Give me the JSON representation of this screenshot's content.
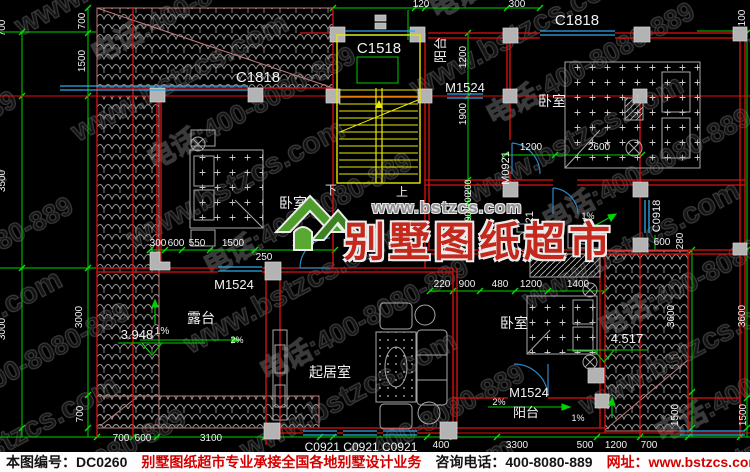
{
  "watermark": {
    "site": "www.bstzcs.com",
    "phone": "电话:400-8080-889"
  },
  "logo": {
    "site": "www.bstzcs.com",
    "name": "别墅图纸超市"
  },
  "footer": {
    "sheet_no": "本图编号：DC0260",
    "slogan": "别墅图纸超市专业承接全国各地别墅设计业务",
    "phone": "咨询电话：400-8080-889",
    "website": "网址：www.bstzcs.com"
  },
  "labels": [
    {
      "name": "dim-120-top",
      "text": "120",
      "x": 421,
      "y": 7,
      "size": 10
    },
    {
      "name": "dim-300-top",
      "text": "300",
      "x": 517,
      "y": 7,
      "size": 10
    },
    {
      "name": "dim-100-top-right",
      "text": "100",
      "x": 745,
      "y": 18,
      "size": 10,
      "rot": -90
    },
    {
      "name": "window-label-c1818-topright",
      "text": "C1818",
      "x": 577,
      "y": 25,
      "size": 15
    },
    {
      "name": "window-label-c1518",
      "text": "C1518",
      "x": 379,
      "y": 53,
      "size": 15
    },
    {
      "name": "room-label-balcony-top",
      "text": "阳台",
      "x": 445,
      "y": 50,
      "size": 13,
      "rot": -90
    },
    {
      "name": "dim-1200-corridor-top",
      "text": "1200",
      "x": 466,
      "y": 57,
      "size": 10,
      "rot": -90
    },
    {
      "name": "door-label-m1524-top",
      "text": "M1524",
      "x": 465,
      "y": 92,
      "size": 13
    },
    {
      "name": "window-label-c1818-topleft",
      "text": "C1818",
      "x": 258,
      "y": 82,
      "size": 15
    },
    {
      "name": "dim-700-left-outer",
      "text": "700",
      "x": 5,
      "y": 28,
      "size": 10,
      "rot": -90
    },
    {
      "name": "dim-700-left-inner",
      "text": "700",
      "x": 85,
      "y": 21,
      "size": 10,
      "rot": -90
    },
    {
      "name": "dim-1500-left-inner",
      "text": "1500",
      "x": 85,
      "y": 61,
      "size": 10,
      "rot": -90
    },
    {
      "name": "room-label-bedroom-topright",
      "text": "卧室",
      "x": 552,
      "y": 106,
      "size": 14
    },
    {
      "name": "dim-1900-corridor",
      "text": "1900",
      "x": 466,
      "y": 114,
      "size": 10,
      "rot": -90
    },
    {
      "name": "dim-1200-bath",
      "text": "1200",
      "x": 531,
      "y": 150,
      "size": 10
    },
    {
      "name": "dim-2600-bath",
      "text": "2600",
      "x": 599,
      "y": 150,
      "size": 10
    },
    {
      "name": "door-label-m0921",
      "text": "M0921",
      "x": 509,
      "y": 168,
      "size": 11,
      "rot": -90
    },
    {
      "name": "stair-label-down",
      "text": "下",
      "x": 331,
      "y": 194,
      "size": 12
    },
    {
      "name": "stair-label-up",
      "text": "上",
      "x": 402,
      "y": 196,
      "size": 12
    },
    {
      "name": "room-label-bedroom-left",
      "text": "卧室",
      "x": 293,
      "y": 208,
      "size": 14
    },
    {
      "name": "dim-200-corridor-a",
      "text": "200",
      "x": 471,
      "y": 187,
      "size": 9,
      "rot": -90
    },
    {
      "name": "dim-200-corridor-b",
      "text": "200",
      "x": 471,
      "y": 200,
      "size": 9,
      "rot": -90
    },
    {
      "name": "dim-900-corridor",
      "text": "900",
      "x": 471,
      "y": 214,
      "size": 9,
      "rot": -90
    },
    {
      "name": "dim-700-corridor",
      "text": "700",
      "x": 471,
      "y": 232,
      "size": 9,
      "rot": -90
    },
    {
      "name": "door-label-m0721",
      "text": "M0721",
      "x": 533,
      "y": 228,
      "size": 11,
      "rot": -90
    },
    {
      "name": "window-label-c0918",
      "text": "C0918",
      "x": 660,
      "y": 216,
      "size": 11,
      "rot": -90
    },
    {
      "name": "dim-280-right",
      "text": "280",
      "x": 683,
      "y": 241,
      "size": 10,
      "rot": -90
    },
    {
      "name": "dim-600-right",
      "text": "600",
      "x": 662,
      "y": 245,
      "size": 10
    },
    {
      "name": "slope-1pct-bath",
      "text": "1%",
      "x": 588,
      "y": 219,
      "size": 9
    },
    {
      "name": "dim-300-mid",
      "text": "300",
      "x": 158,
      "y": 246,
      "size": 10
    },
    {
      "name": "dim-600-mid",
      "text": "600",
      "x": 176,
      "y": 246,
      "size": 10
    },
    {
      "name": "dim-550-mid",
      "text": "550",
      "x": 197,
      "y": 246,
      "size": 10
    },
    {
      "name": "dim-1500-mid",
      "text": "1500",
      "x": 233,
      "y": 246,
      "size": 10
    },
    {
      "name": "dim-1800-mid",
      "text": "1800",
      "x": 303,
      "y": 246,
      "size": 10
    },
    {
      "name": "dim-250-mid",
      "text": "250",
      "x": 264,
      "y": 260,
      "size": 10
    },
    {
      "name": "door-label-m1524-left",
      "text": "M1524",
      "x": 234,
      "y": 289,
      "size": 13
    },
    {
      "name": "dim-220-bed",
      "text": "220",
      "x": 442,
      "y": 287,
      "size": 10
    },
    {
      "name": "dim-900-bed",
      "text": "900",
      "x": 467,
      "y": 287,
      "size": 10
    },
    {
      "name": "dim-480-bed",
      "text": "480",
      "x": 500,
      "y": 287,
      "size": 10
    },
    {
      "name": "dim-1200-bed",
      "text": "1200",
      "x": 531,
      "y": 287,
      "size": 10
    },
    {
      "name": "dim-1400-bed",
      "text": "1400",
      "x": 578,
      "y": 287,
      "size": 10
    },
    {
      "name": "dim-3000-left-inner",
      "text": "3000",
      "x": 82,
      "y": 317,
      "size": 10,
      "rot": -90
    },
    {
      "name": "dim-3500-left-outer",
      "text": "3500",
      "x": 5,
      "y": 181,
      "size": 10,
      "rot": -90
    },
    {
      "name": "dim-3000-left-outer",
      "text": "3000",
      "x": 5,
      "y": 329,
      "size": 10,
      "rot": -90
    },
    {
      "name": "room-label-terrace",
      "text": "露台",
      "x": 201,
      "y": 323,
      "size": 14
    },
    {
      "name": "elev-3948",
      "text": "3.948",
      "x": 137,
      "y": 339,
      "size": 13
    },
    {
      "name": "slope-1pct-terrace",
      "text": "1%",
      "x": 162,
      "y": 334,
      "size": 10
    },
    {
      "name": "slope-2pct-terrace",
      "text": "2%",
      "x": 237,
      "y": 343,
      "size": 9
    },
    {
      "name": "room-label-bedroom-bottom",
      "text": "卧室",
      "x": 514,
      "y": 328,
      "size": 14
    },
    {
      "name": "elev-4517",
      "text": "4.517",
      "x": 627,
      "y": 343,
      "size": 13
    },
    {
      "name": "dim-3600-right-inner",
      "text": "3600",
      "x": 674,
      "y": 316,
      "size": 10,
      "rot": -90
    },
    {
      "name": "dim-3600-right-outer",
      "text": "3600",
      "x": 745,
      "y": 316,
      "size": 10,
      "rot": -90
    },
    {
      "name": "room-label-living",
      "text": "起居室",
      "x": 330,
      "y": 377,
      "size": 14
    },
    {
      "name": "door-label-m1524-bottom",
      "text": "M1524",
      "x": 529,
      "y": 397,
      "size": 13
    },
    {
      "name": "slope-2pct-balcony",
      "text": "2%",
      "x": 499,
      "y": 405,
      "size": 9
    },
    {
      "name": "room-label-balcony-bottom",
      "text": "阳台",
      "x": 526,
      "y": 417,
      "size": 13
    },
    {
      "name": "slope-1pct-balcony",
      "text": "1%",
      "x": 578,
      "y": 421,
      "size": 9
    },
    {
      "name": "dim-700-left-bottom",
      "text": "700",
      "x": 83,
      "y": 414,
      "size": 10,
      "rot": -90
    },
    {
      "name": "dim-1500-right-inner",
      "text": "1500",
      "x": 678,
      "y": 415,
      "size": 10,
      "rot": -90
    },
    {
      "name": "dim-1500-right-outer",
      "text": "1500",
      "x": 746,
      "y": 415,
      "size": 10,
      "rot": -90
    },
    {
      "name": "dim-700-bottom-a",
      "text": "700",
      "x": 121,
      "y": 441,
      "size": 10
    },
    {
      "name": "dim-600-bottom",
      "text": "600",
      "x": 143,
      "y": 441,
      "size": 10
    },
    {
      "name": "dim-3100-bottom",
      "text": "3100",
      "x": 211,
      "y": 441,
      "size": 10
    },
    {
      "name": "window-label-c0921-row",
      "text": "C0921 C0921 C0921",
      "x": 361,
      "y": 451,
      "size": 12
    },
    {
      "name": "dim-400-bottom",
      "text": "400",
      "x": 441,
      "y": 448,
      "size": 10
    },
    {
      "name": "dim-3300-bottom",
      "text": "3300",
      "x": 517,
      "y": 448,
      "size": 10
    },
    {
      "name": "dim-500-bottom",
      "text": "500",
      "x": 585,
      "y": 448,
      "size": 10
    },
    {
      "name": "dim-1200-bottom",
      "text": "1200",
      "x": 616,
      "y": 448,
      "size": 10
    },
    {
      "name": "dim-700-bottom-b",
      "text": "700",
      "x": 649,
      "y": 448,
      "size": 10
    }
  ]
}
